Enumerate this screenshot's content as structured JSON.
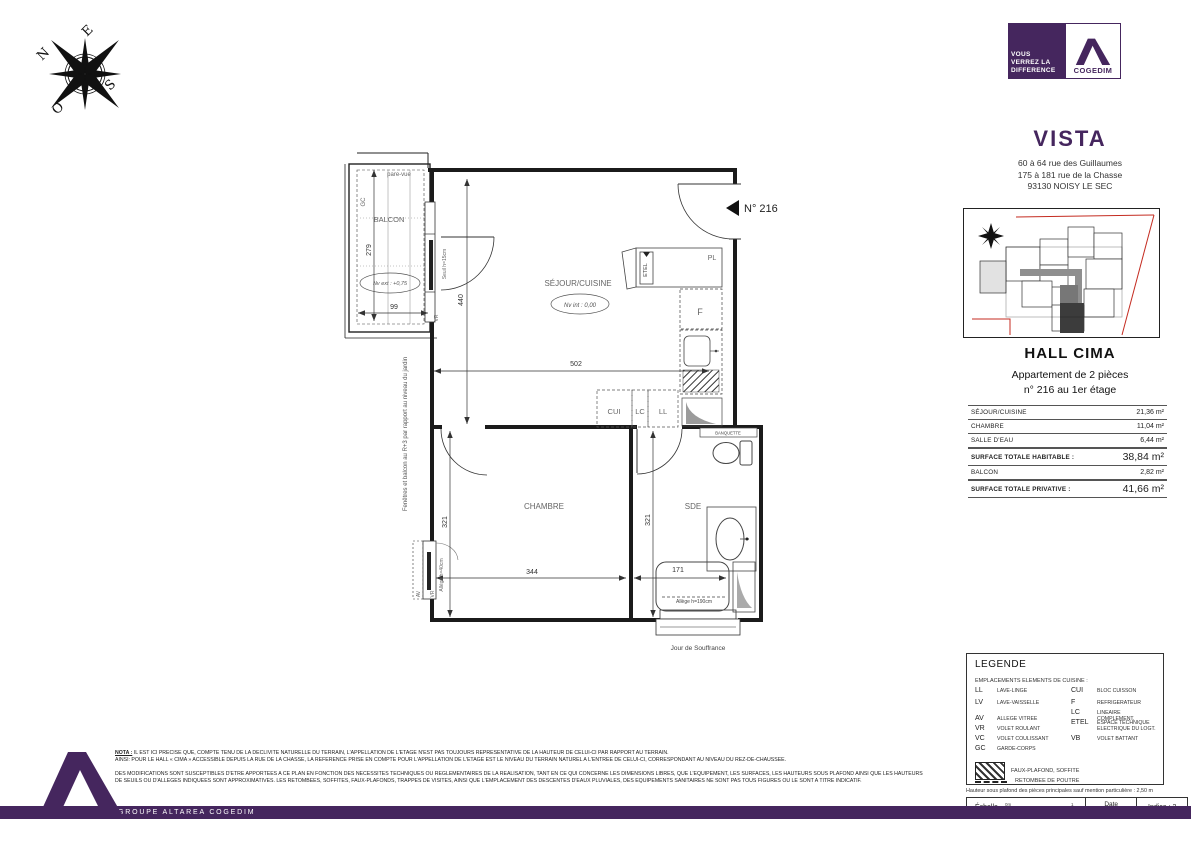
{
  "colors": {
    "brand_purple": "#45265E",
    "boundary_red": "#C42B20"
  },
  "compass": {
    "n": "N",
    "e": "E",
    "s": "S",
    "o": "O"
  },
  "logo": {
    "tagline1": "VOUS",
    "tagline2": "VERREZ LA",
    "tagline3": "DIFFERENCE",
    "name": "COGEDIM"
  },
  "project": {
    "name": "VISTA",
    "address1": "60 à 64 rue des Guillaumes",
    "address2": "175 à 181 rue de la Chasse",
    "address3": "93130 NOISY LE SEC"
  },
  "apartment": {
    "hall": "HALL CIMA",
    "type": "Appartement de 2 pièces",
    "unit": "n° 216 au 1er étage"
  },
  "areas": {
    "rows": [
      {
        "label": "SÉJOUR/CUISINE",
        "value": "21,36 m²"
      },
      {
        "label": "CHAMBRE",
        "value": "11,04 m²"
      },
      {
        "label": "SALLE D'EAU",
        "value": "6,44 m²"
      },
      {
        "label": "SURFACE TOTALE HABITABLE :",
        "value": "38,84 m²"
      },
      {
        "label": "BALCON",
        "value": "2,82 m²"
      },
      {
        "label": "SURFACE TOTALE PRIVATIVE :",
        "value": "41,66 m²"
      }
    ]
  },
  "plan": {
    "unit_marker": "N° 216",
    "sejour": "SÉJOUR/CUISINE",
    "niv_int": "Nv int : 0,00",
    "chambre": "CHAMBRE",
    "sde": "SDE",
    "balcon": "BALCON",
    "pare_vue": "pare-vue",
    "gc": "GC",
    "niv_ext": "Nv ext : +0,75",
    "pl": "PL",
    "etel": "ETEL",
    "f": "F",
    "cui": "CUI",
    "lc": "LC",
    "ll": "LL",
    "banquette": "BANQUETTE",
    "seuil": "Seuil h=15cm",
    "vr": "VR",
    "av": "AV",
    "allege40": "Allège h=40cm",
    "allege190": "Allège h=190cm",
    "jour_de_souffrance": "Jour de Souffrance",
    "window_note": "Fenêtres et balcon au R+3 par rapport au niveau du jardin",
    "dims": {
      "d502": "502",
      "d440": "440",
      "d279": "279",
      "d99": "99",
      "d344": "344",
      "d321l": "321",
      "d321r": "321",
      "d171": "171"
    }
  },
  "legend": {
    "title": "LEGENDE",
    "subtitle": "EMPLACEMENTS ELEMENTS DE CUISINE :",
    "items": [
      {
        "abbr": "LL",
        "label": "LAVE-LINGE"
      },
      {
        "abbr": "LV",
        "label": "LAVE-VAISSELLE"
      },
      {
        "abbr": "AV",
        "label": "ALLEGE VITREE"
      },
      {
        "abbr": "VR",
        "label": "VOLET ROULANT"
      },
      {
        "abbr": "VC",
        "label": "VOLET COULISSANT"
      },
      {
        "abbr": "GC",
        "label": "GARDE-CORPS"
      },
      {
        "abbr": "CUI",
        "label": "BLOC CUISSON"
      },
      {
        "abbr": "F",
        "label": "REFRIGERATEUR"
      },
      {
        "abbr": "LC",
        "label": "LINEAIRE COMPLEMENT."
      },
      {
        "abbr": "ETEL",
        "label": "ESPACE TECHNIQUE ELECTRIQUE DU LOGT."
      },
      {
        "abbr": "VB",
        "label": "VOLET BATTANT"
      }
    ],
    "hatch_label": "FAUX-PLAFOND, SOFFITE",
    "dash_label": "RETOMBEE DE POUTRE",
    "ceiling_note": "Hauteur sous plafond des pièces principales sauf mention particulière : 2,50 m"
  },
  "titleblock": {
    "scale_label": "Échelle",
    "scale_zero": "0m",
    "scale_one": "1",
    "date_label": "Date",
    "date_value": "DCE Sept 2019",
    "indice": "Indice : 2"
  },
  "notes": {
    "nota_label": "NOTA :",
    "line1": "IL EST ICI PRECISE QUE, COMPTE TENU DE LA DECLIVITE NATURELLE DU TERRAIN, L'APPELLATION DE L'ETAGE N'EST PAS TOUJOURS REPRESENTATIVE DE LA HAUTEUR DE CELUI-CI PAR RAPPORT AU TERRAIN.",
    "line2": "AINSI: POUR LE HALL « CIMA » ACCESSIBLE DEPUIS LA RUE DE LA CHASSE, LA REFERENCE PRISE EN COMPTE POUR L'APPELLATION DE L'ETAGE EST LE NIVEAU DU TERRAIN NATUREL A L'ENTREE DE CELUI-CI, CORRESPONDANT AU NIVEAU DU REZ-DE-CHAUSSEE.",
    "para2": "DES MODIFICATIONS SONT SUSCEPTIBLES D'ETRE APPORTEES A CE PLAN EN FONCTION DES NECESSITES TECHNIQUES OU REGLEMENTAIRES DE LA REALISATION, TANT EN CE QUI CONCERNE LES DIMENSIONS LIBRES, QUE L'EQUIPEMENT, LES SURFACES, LES HAUTEURS SOUS PLAFOND AINSI QUE LES HAUTEURS DE SEUILS OU D'ALLEGES INDIQUEES SONT APPROXIMATIVES. LES RETOMBEES, SOFFITES, FAUX-PLAFONDS, TRAPPES DE VISITES, AINSI QUE L'EMPLACEMENT DES DESCENTES D'EAUX PLUVIALES, DES EQUIPEMENTS SANITAIRES NE SONT PAS TOUS FIGURES OU LE SONT A TITRE INDICATIF."
  },
  "footer": {
    "group": "GROUPE ALTAREA COGEDIM"
  }
}
